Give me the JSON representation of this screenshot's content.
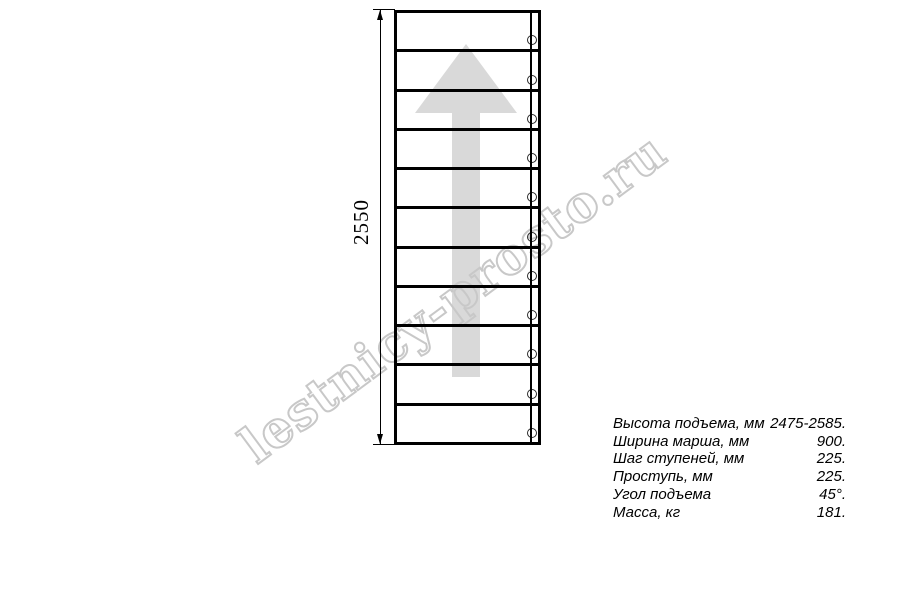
{
  "watermark": {
    "text": "lestnicy-prosto.ru"
  },
  "colors": {
    "line": "#000000",
    "arrow": "#d9d9d9",
    "watermark": "#c8c8c8"
  },
  "dimension": {
    "label": "2550"
  },
  "staircase": {
    "treads": 11,
    "direction_arrow_icon": "up-arrow",
    "fastener_icon": "circle"
  },
  "specs": {
    "rows": [
      {
        "label": "Высота подъема, мм",
        "value": "2475-2585."
      },
      {
        "label": "Ширина марша, мм",
        "value": "900."
      },
      {
        "label": "Шаг ступеней, мм",
        "value": "225."
      },
      {
        "label": "Проступь, мм",
        "value": "225."
      },
      {
        "label": "Угол подъема",
        "value": "45°."
      },
      {
        "label": "Масса, кг",
        "value": "181."
      }
    ]
  }
}
